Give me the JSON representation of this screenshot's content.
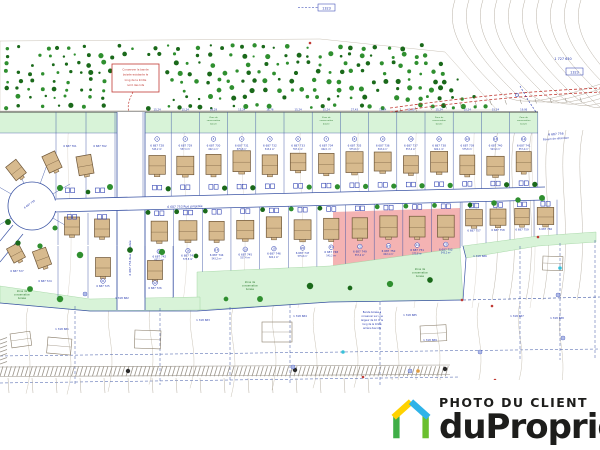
{
  "watermark": {
    "line1": "PHOTO DU CLIENT",
    "line2": "duProprio",
    "text_color": "#1d1d1b",
    "logo_colors": {
      "left_wall": "#3fae47",
      "left_roof": "#ffd200",
      "right_roof": "#2fb3e8",
      "right_wall": "#6abf2e"
    }
  },
  "plan": {
    "colors": {
      "tree_dark": "#1a691a",
      "tree_light": "#2f8f2f",
      "conservation_green": "#d8f3d8",
      "zone_text_green": "#2f7d32",
      "pink": "#f4b3b3",
      "house_fill": "#d7ba8e",
      "house_stroke": "#6e5638",
      "blue": "#3c55a5",
      "dim_blue": "#2336ad",
      "gray_contour": "#b8b0a4",
      "faint_contour": "#d9d3c9",
      "red": "#c03a34",
      "hatch_gray": "#9a948a",
      "black_line": "#4a4a45",
      "outline_house": "#8b7f6c"
    },
    "labels": {
      "top_right_lot": "1 727 630",
      "grid_box": "1323",
      "basin_line1": "6 687 756",
      "basin_line2": "Bassin de rétention",
      "road_h": "6 687 753   Rue projetée",
      "road_v": "6 687 754  Rue projetée",
      "culdesac_label": "6 687 755",
      "red_note_lines": [
        "Conserver la bande",
        "boisée existante le",
        "long de la limite",
        "nord des lots"
      ],
      "zone_note_lines": [
        "Zone de",
        "conservation",
        "boisée"
      ],
      "bottom_note_lines": [
        "Bande boisée à",
        "conserver sur une",
        "largeur de 10 m le",
        "long de la limite",
        "arrière des lots"
      ]
    },
    "row1_lot_numbers": [
      "6 687 728",
      "6 687 729",
      "6 687 730",
      "6 687 731",
      "6 687 732",
      "6 687 733",
      "6 687 734",
      "6 687 735",
      "6 687 736",
      "6 687 737",
      "6 687 738",
      "6 687 739",
      "6 687 740",
      "6 687 741"
    ],
    "row2_lot_numbers": [
      "6 687 742",
      "6 687 743",
      "6 687 744",
      "6 687 745",
      "6 687 746",
      "6 687 747",
      "6 687 748",
      "6 687 749",
      "6 687 750",
      "6 687 751",
      "6 687 752",
      "6 687 757",
      "6 687 758",
      "6 687 759",
      "6 687 760"
    ],
    "left_lot_numbers": [
      "6 687 724",
      "6 687 725",
      "6 687 726",
      "6 687 727",
      "6 687 761",
      "6 687 762"
    ],
    "existing_lot_numbers": [
      "1 318 681",
      "1 318 682",
      "1 318 683",
      "1 318 684",
      "1 318 685",
      "1 318 686",
      "1 318 687",
      "1 318 688",
      "1 318 689"
    ],
    "areas": [
      "543,2 m²",
      "557,4 m²",
      "602,1 m²",
      "575,8 m²"
    ],
    "dimensions": [
      "15,24",
      "15,24",
      "18,29",
      "15,24",
      "16,76",
      "15,24",
      "15,24",
      "27,43",
      "15,24",
      "12,80",
      "15,24",
      "15,24",
      "15,24",
      "19,06"
    ]
  }
}
